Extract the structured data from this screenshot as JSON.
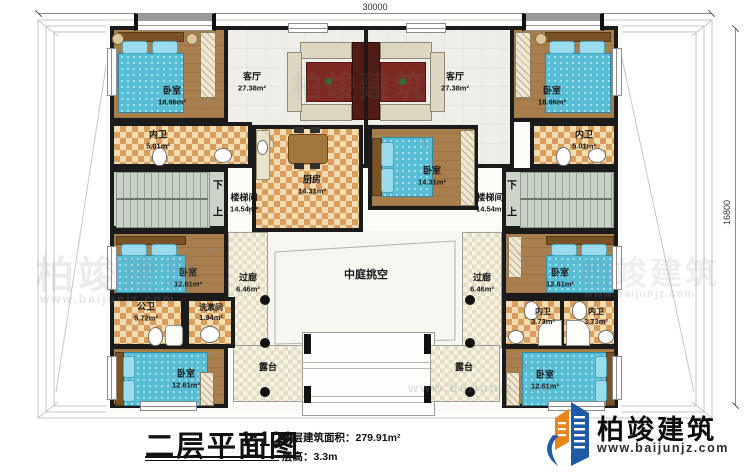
{
  "meta": {
    "plan_title": "二层平面图",
    "scale": "1:100",
    "area_label": "本层建筑面积：",
    "area_value": "279.91m²",
    "floor_height_label": "层高：",
    "floor_height_value": "3.3m"
  },
  "dimensions": {
    "top": "30000",
    "right": "16800"
  },
  "logo": {
    "name": "柏竣建筑",
    "url": "www.baijunjz.com"
  },
  "watermark": {
    "brand": "柏竣建筑",
    "url": "www.baijunjz.com"
  },
  "stairs": {
    "down": "下",
    "up": "上"
  },
  "rooms": {
    "bedroom_tl": {
      "name": "卧室",
      "area": "18.96m²"
    },
    "living_l": {
      "name": "客厅",
      "area": "27.38m²"
    },
    "living_r": {
      "name": "客厅",
      "area": "27.38m²"
    },
    "bedroom_tr": {
      "name": "卧室",
      "area": "18.96m²"
    },
    "bath_tl": {
      "name": "内卫",
      "area": "5.01m²"
    },
    "bath_tr": {
      "name": "内卫",
      "area": "5.01m²"
    },
    "stair_l": {
      "name": "楼梯间",
      "area": "14.54m²"
    },
    "stair_r": {
      "name": "楼梯间",
      "area": "14.54m²"
    },
    "kitchen": {
      "name": "厨房",
      "area": "14.31m²"
    },
    "bedroom_m": {
      "name": "卧室",
      "area": "14.31m²"
    },
    "corridor_l": {
      "name": "过廊",
      "area": "6.46m²"
    },
    "corridor_r": {
      "name": "过廊",
      "area": "6.46m²"
    },
    "atrium": {
      "name": "中庭挑空"
    },
    "bedroom_bl1": {
      "name": "卧室",
      "area": "12.61m²"
    },
    "pubbath": {
      "name": "公卫",
      "area": "5.72m²"
    },
    "washroom": {
      "name": "洗漱间",
      "area": "1.94m²"
    },
    "bedroom_bl2": {
      "name": "卧室",
      "area": "12.61m²"
    },
    "bedroom_br1": {
      "name": "卧室",
      "area": "12.61m²"
    },
    "bath_br1": {
      "name": "内卫",
      "area": "3.73m²"
    },
    "bath_br2": {
      "name": "内卫",
      "area": "3.73m²"
    },
    "bedroom_br2": {
      "name": "卧室",
      "area": "12.61m²"
    },
    "terrace_l": {
      "name": "露台"
    },
    "terrace_r": {
      "name": "露台"
    }
  }
}
